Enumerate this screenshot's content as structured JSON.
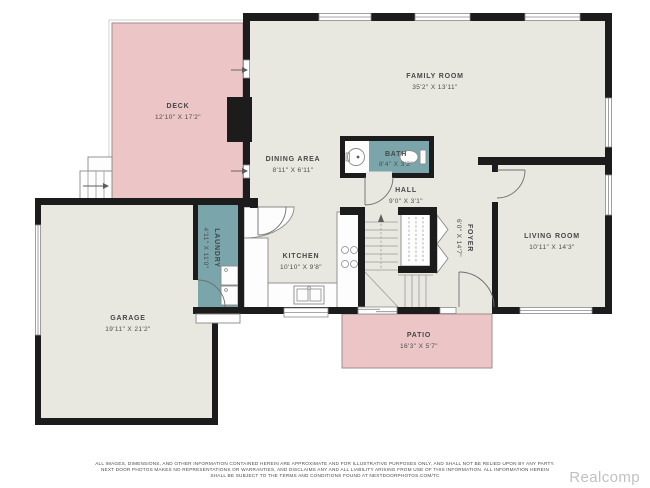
{
  "colors": {
    "wall": "#1c1c1c",
    "floor": "#e8e7e0",
    "outdoor_pink": "#ecc5c7",
    "wet_room_teal": "#7aa6ab",
    "label_text": "#474747",
    "watermark_gray": "#c1c1c1",
    "background": "#ffffff"
  },
  "rooms": {
    "deck": {
      "name": "DECK",
      "dims": "12'10\" X 17'2\""
    },
    "family_room": {
      "name": "FAMILY ROOM",
      "dims": "35'2\" X 13'11\""
    },
    "dining_area": {
      "name": "DINING AREA",
      "dims": "8'11\" X 6'11\""
    },
    "bath": {
      "name": "BATH",
      "dims": "8'4\" X 3'2\""
    },
    "hall": {
      "name": "HALL",
      "dims": "9'0\" X 3'1\""
    },
    "foyer": {
      "name": "FOYER",
      "dims": "6'0\" X 14'7\""
    },
    "living_room": {
      "name": "LIVING ROOM",
      "dims": "10'11\" X 14'3\""
    },
    "kitchen": {
      "name": "KITCHEN",
      "dims": "10'10\" X 9'8\""
    },
    "laundry": {
      "name": "LAUNDRY",
      "dims": "4'11\" X 11'0\""
    },
    "garage": {
      "name": "GARAGE",
      "dims": "19'11\" X 21'2\""
    },
    "patio": {
      "name": "PATIO",
      "dims": "16'3\" X 5'7\""
    }
  },
  "footer": {
    "disclaimer_line1": "ALL IMAGES, DIMENSIONS, AND OTHER INFORMATION CONTAINED HEREIN ARE APPROXIMATE AND FOR ILLUSTRATIVE PURPOSES ONLY, AND SHALL NOT BE RELIED UPON BY ANY PARTY.",
    "disclaimer_line2": "NEXT DOOR PHOTOS MAKES NO REPRESENTATIONS OR WARRANTIES, AND DISCLAIMS ANY AND ALL LIABILITY ARISING FROM USE OF THIS INFORMATION. ALL INFORMATION HEREIN",
    "disclaimer_line3": "SHALL BE SUBJECT TO THE TERMS AND CONDITIONS FOUND AT NEXTDOORPHOTOS.COM/TC",
    "watermark": "Realcomp"
  }
}
